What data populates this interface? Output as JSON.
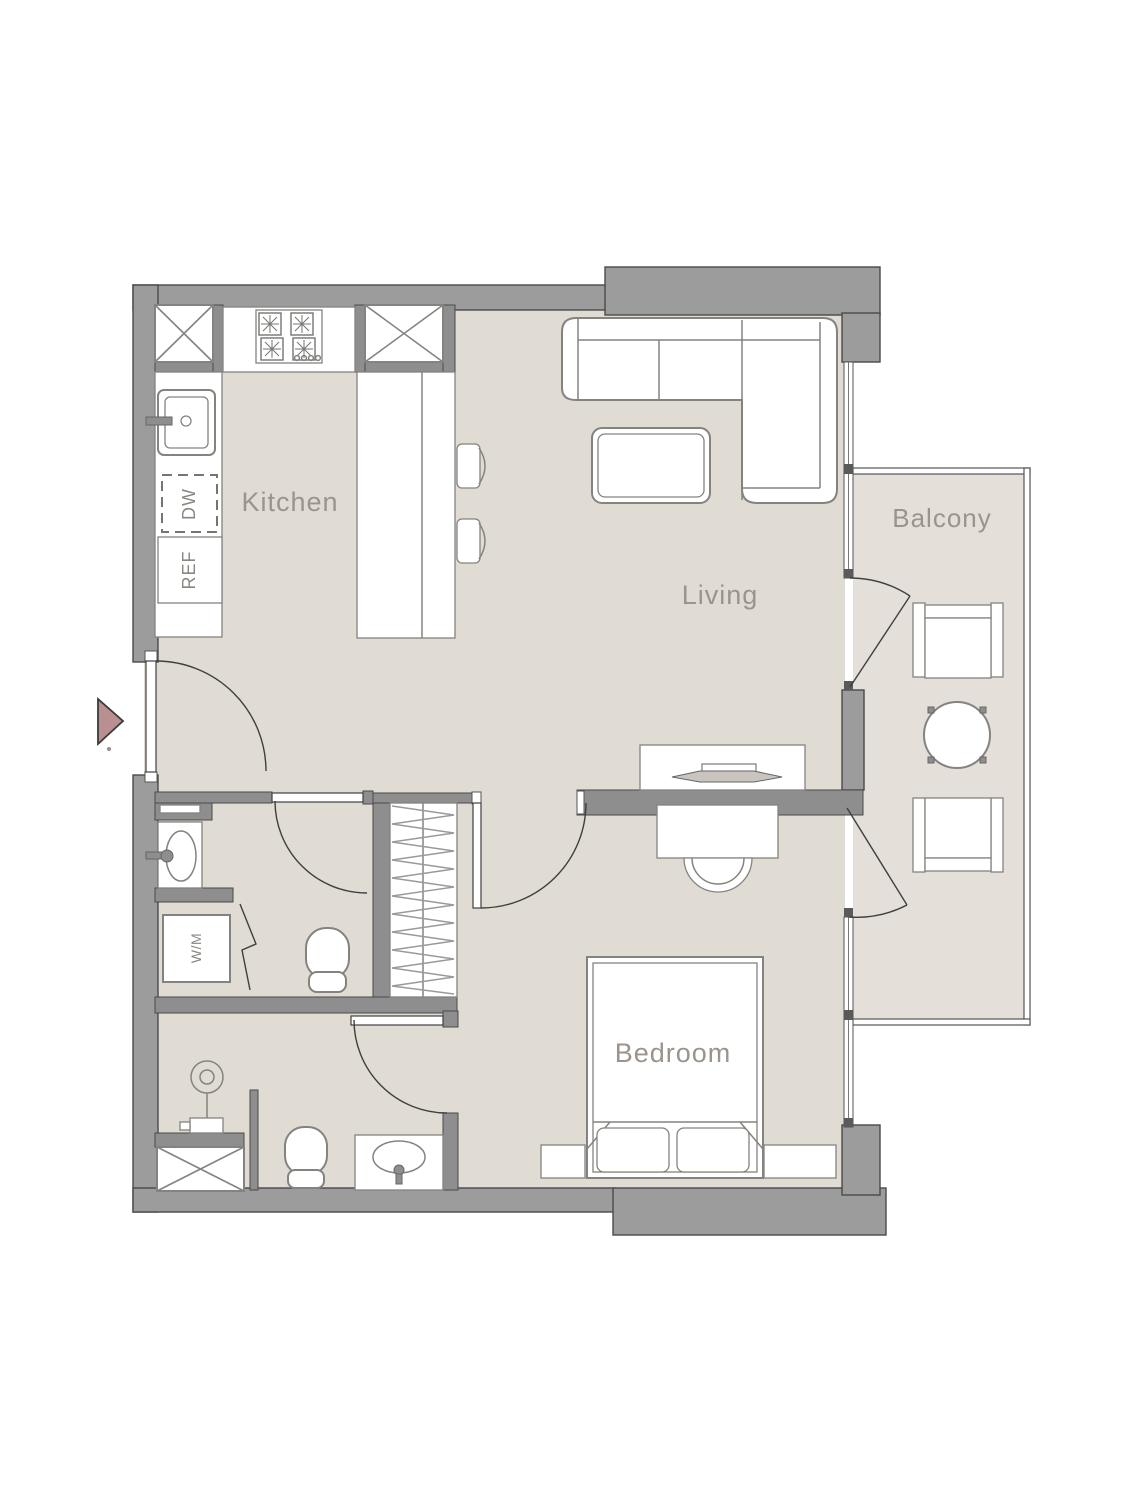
{
  "page": {
    "background": "#ffffff"
  },
  "plan": {
    "rooms": {
      "kitchen": {
        "label": "Kitchen"
      },
      "living": {
        "label": "Living"
      },
      "bedroom": {
        "label": "Bedroom"
      },
      "balcony": {
        "label": "Balcony"
      }
    },
    "appliances": {
      "dishwasher": {
        "label": "DW"
      },
      "refrigerator": {
        "label": "REF"
      },
      "washing_machine": {
        "label": "W/M"
      }
    },
    "icons": {
      "entry_marker": "entry-arrow",
      "shaft": "crossed-box-icon",
      "shower": "shower-head-icon"
    },
    "colors": {
      "floor": "#e0dbd3",
      "balcony_floor": "#e4dfd8",
      "wall": "#9c9c9c",
      "partition": "#8e8e8e",
      "outline": "#4a4a4a",
      "fixture": "#85837f",
      "door": "#3f3f3f",
      "hatch": "#9a9a9a",
      "label_text": "#9a948d",
      "entry_arrow": "#b98f8f",
      "tv_fill": "#c9c4be"
    }
  }
}
